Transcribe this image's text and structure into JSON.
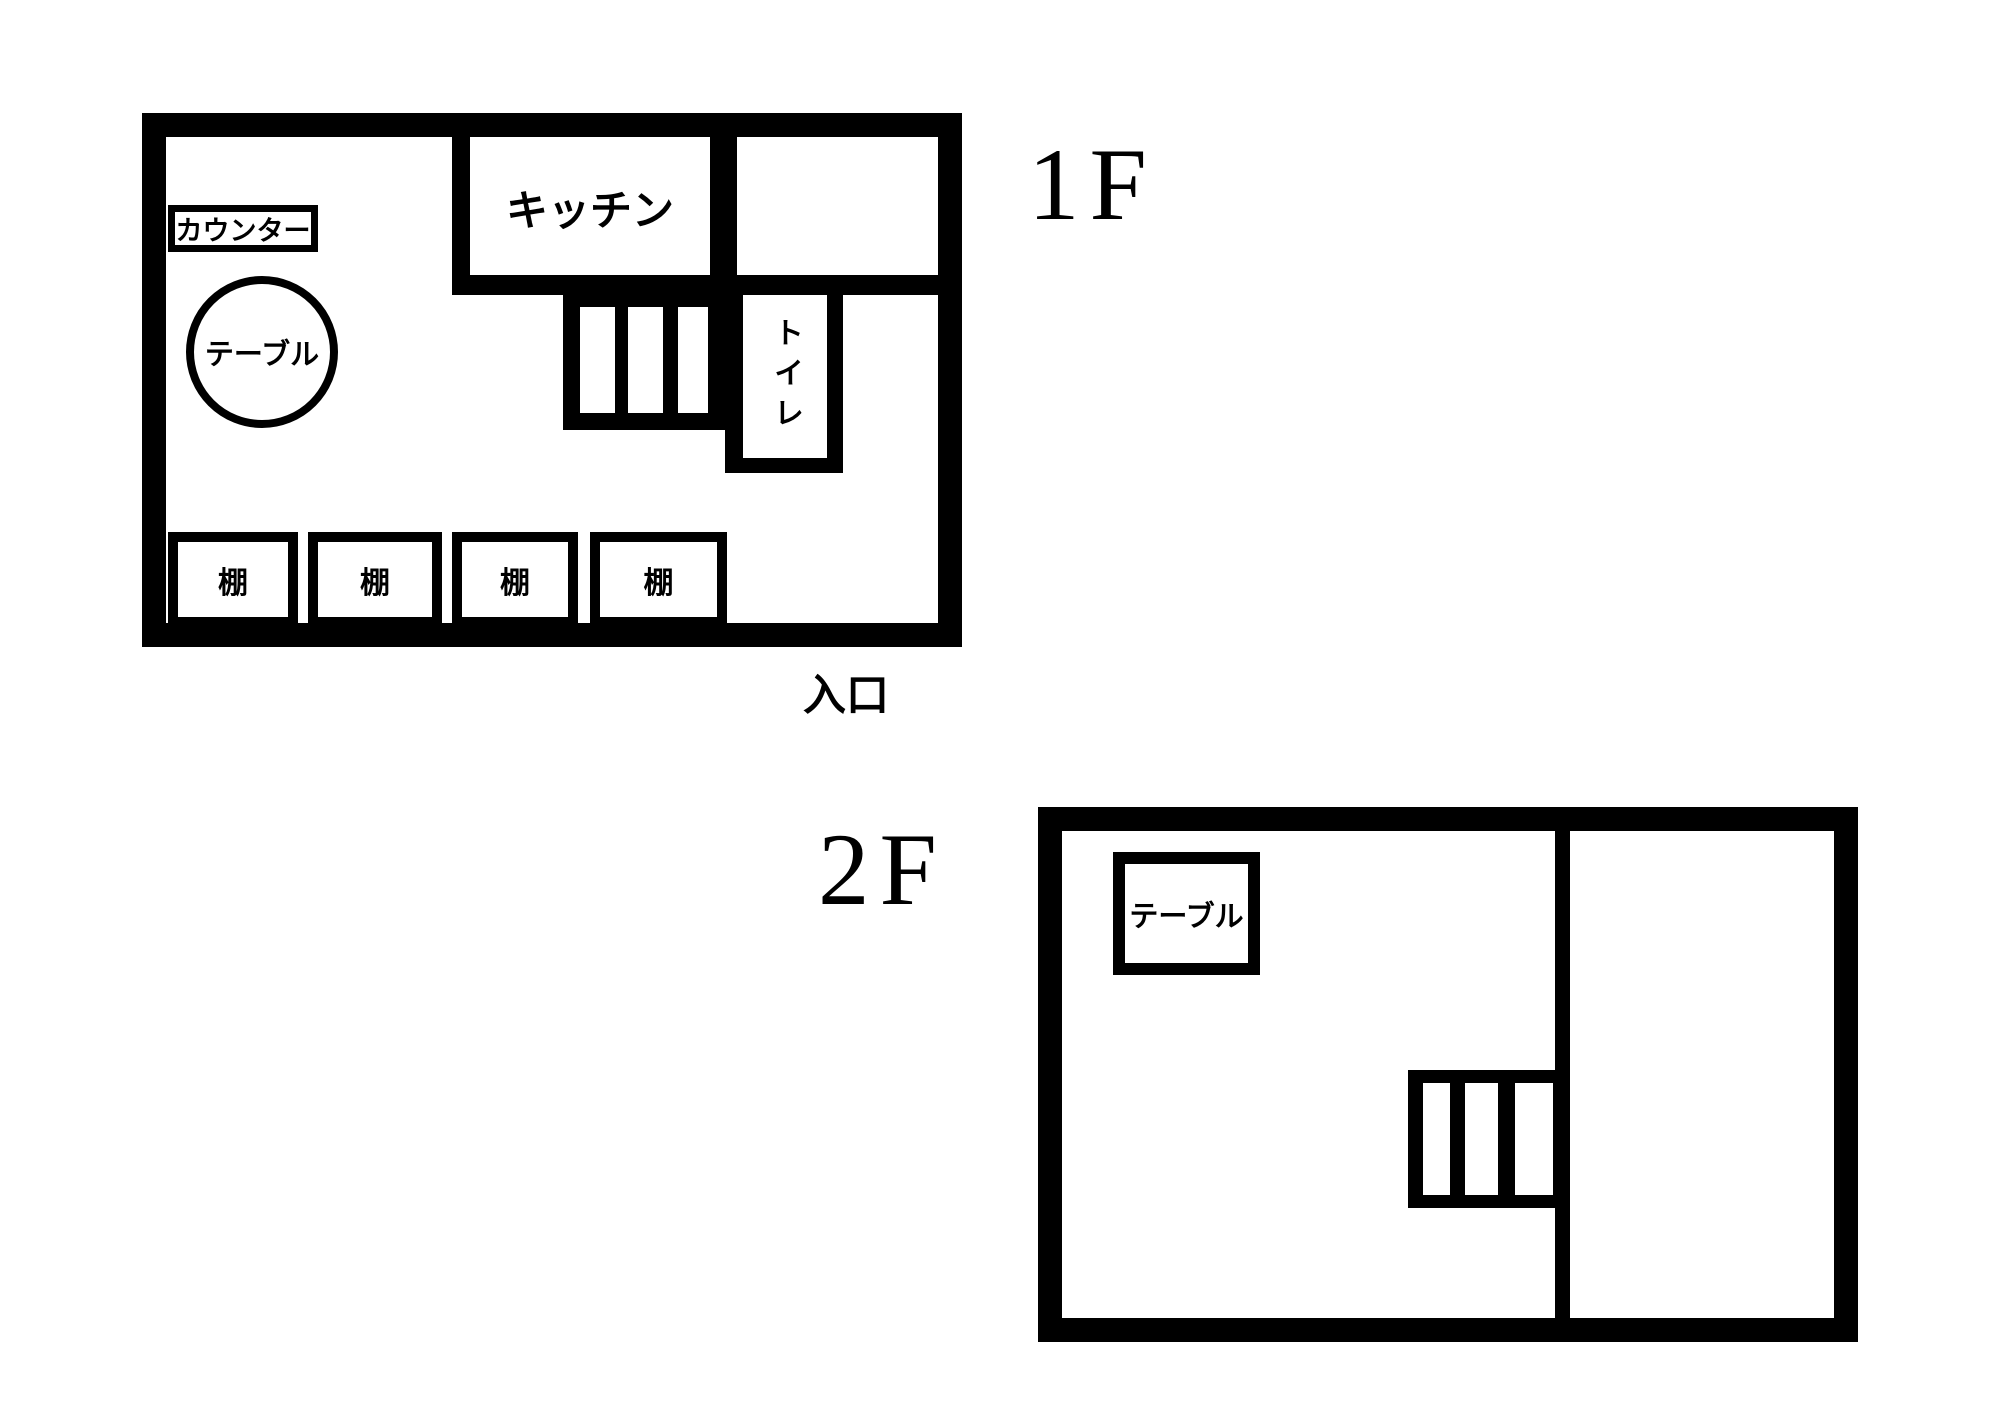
{
  "page": {
    "background": "#ffffff",
    "ink": "#000000"
  },
  "floor1": {
    "title": "1F",
    "entrance_label": "入口",
    "kitchen_label": "キッチン",
    "toilet_label": "トイレ",
    "counter_label": "カウンター",
    "table_label": "テーブル",
    "shelves": [
      "棚",
      "棚",
      "棚",
      "棚"
    ]
  },
  "floor2": {
    "title": "2F",
    "table_label": "テーブル"
  }
}
